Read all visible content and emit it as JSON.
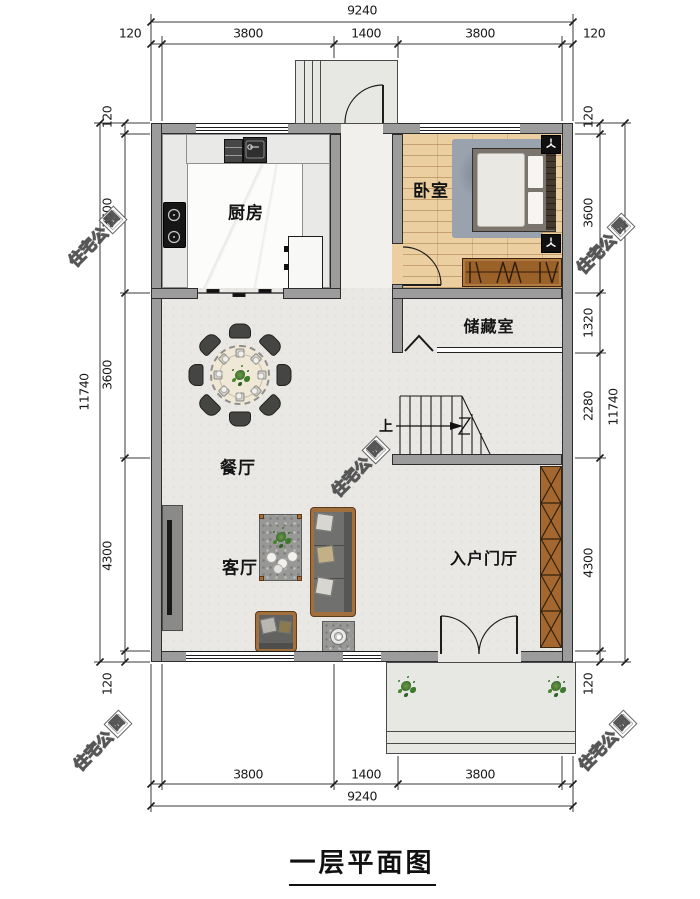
{
  "title": "一层平面图",
  "watermark": {
    "main": "住宅公",
    "logo": "园"
  },
  "rooms": {
    "kitchen": "厨房",
    "bedroom": "卧室",
    "storage": "储藏室",
    "dining": "餐厅",
    "living": "客厅",
    "entry": "入户门厅"
  },
  "stairs": {
    "up": "上"
  },
  "dims": {
    "top_overall": "9240",
    "top_seg": [
      "120",
      "3800",
      "1400",
      "3800",
      "120"
    ],
    "bottom_seg": [
      "3800",
      "1400",
      "3800"
    ],
    "bottom_overall": "9240",
    "left_overall": "11740",
    "left_seg": [
      "120",
      "3600",
      "3600",
      "4300",
      "120"
    ],
    "right_overall": "11740",
    "right_seg": [
      "120",
      "3600",
      "1320",
      "2280",
      "4300",
      "120"
    ]
  },
  "colors": {
    "wall": "#9c9c9c",
    "wall_line": "#2d2d2d",
    "floor": "#e9e8e5",
    "corridor": "#f1f0ed",
    "wood": "#ebcfa0",
    "counter": "#e9e9e7",
    "marble": "#fcfcfb",
    "porch": "#e7e7e4",
    "table": "#efe8d6",
    "chair": "#454543",
    "brown": "#9a6128",
    "frame": "#a2703c",
    "cabx": "#a4672f",
    "rug": "#9aa2ae",
    "sofa": "#70706e"
  }
}
